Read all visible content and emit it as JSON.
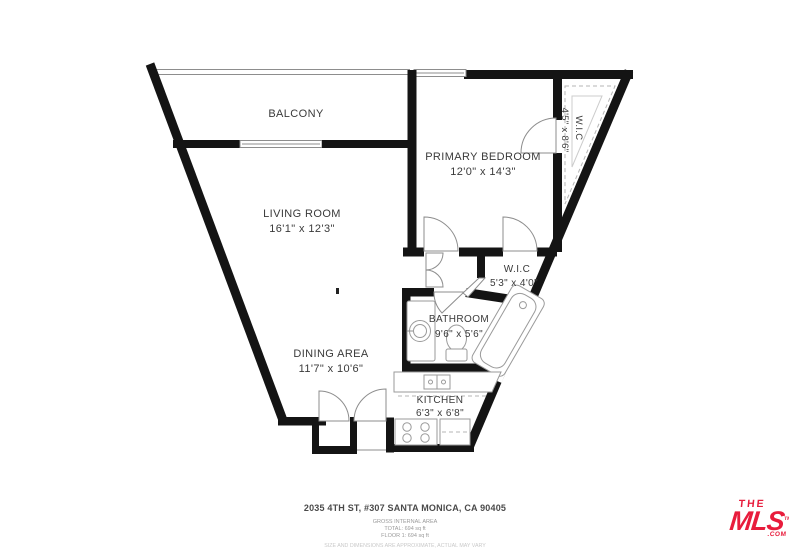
{
  "title": "Floor plan",
  "rooms": {
    "balcony": {
      "name": "BALCONY"
    },
    "living": {
      "name": "LIVING ROOM",
      "dims": "16'1\" x 12'3\""
    },
    "bedroom": {
      "name": "PRIMARY BEDROOM",
      "dims": "12'0\" x 14'3\""
    },
    "wic_top": {
      "name": "W.I.C",
      "dims": "4'5\" x 8'6\""
    },
    "wic_small": {
      "name": "W.I.C",
      "dims": "5'3\" x 4'0\""
    },
    "bathroom": {
      "name": "BATHROOM",
      "dims": "9'6\" x 5'6\""
    },
    "dining": {
      "name": "DINING AREA",
      "dims": "11'7\" x 10'6\""
    },
    "kitchen": {
      "name": "KITCHEN",
      "dims": "6'3\" x 6'8\""
    }
  },
  "footer": {
    "address": "2035 4TH ST, #307 SANTA MONICA, CA 90405",
    "area_title": "GROSS INTERNAL AREA",
    "area_total": "TOTAL: 694 sq ft",
    "area_floor": "FLOOR 1: 694 sq ft",
    "disclaimer": "SIZE AND DIMENSIONS ARE APPROXIMATE, ACTUAL MAY VARY"
  },
  "logo": {
    "line1": "THE",
    "line2": "MLS",
    "suffix": ".COM",
    "tm": "TM",
    "color": "#e81c3c"
  },
  "colors": {
    "wall": "#141414",
    "label": "#3a3a3a",
    "fixture": "#9a9a9a",
    "dash": "#b5b5b5"
  }
}
